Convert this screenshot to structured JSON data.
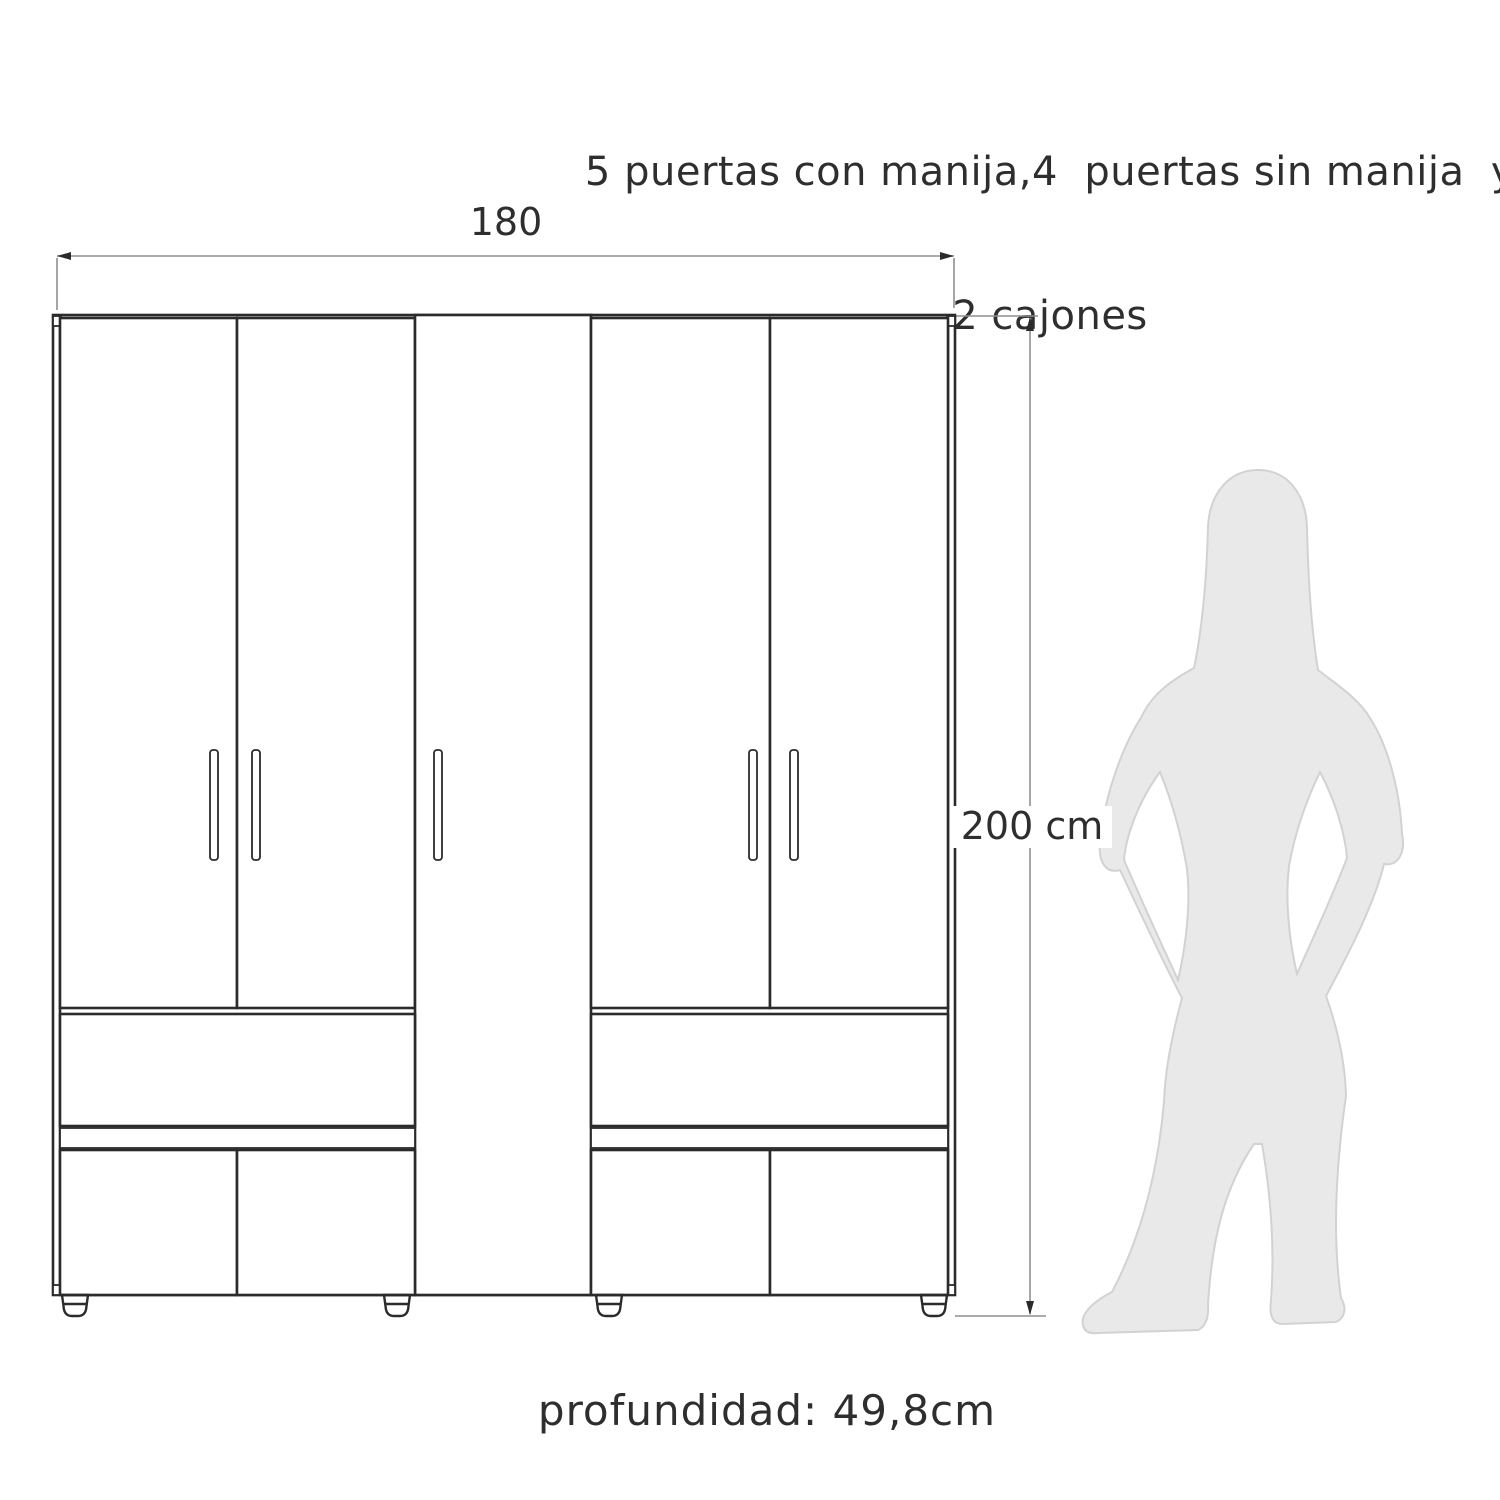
{
  "title": {
    "line1": "5 puertas con manija,4  puertas sin manija  y",
    "line2": "2 cajones"
  },
  "dimensions": {
    "width": "180",
    "height": "200 cm",
    "depth": "profundidad: 49,8cm"
  },
  "features": {
    "doors_with_handle": "5",
    "doors_without_handle": "4",
    "drawers": "2"
  },
  "colors": {
    "background": "#ffffff",
    "line": "#2b2b2b",
    "dimension_line": "#8f8f8f",
    "text": "#2e2e2e",
    "silhouette_fill": "#e9e9e9",
    "silhouette_outline": "#d2d2d2"
  }
}
